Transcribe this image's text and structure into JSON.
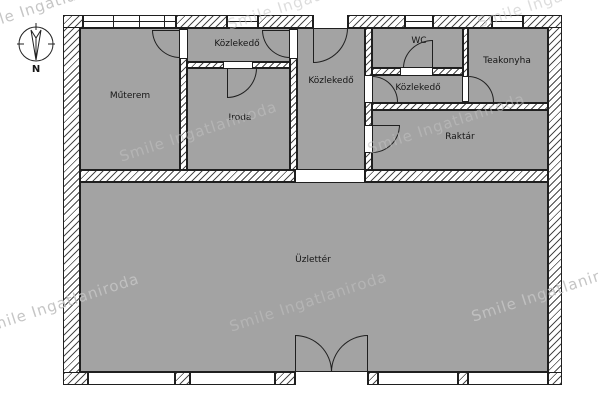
{
  "plan": {
    "compass_label": "N",
    "watermark_text": "Smile Ingatlaniroda",
    "rooms": [
      {
        "name": "muterem",
        "label": "Műterem"
      },
      {
        "name": "kozlekedo_top_left",
        "label": "Közlekedő"
      },
      {
        "name": "iroda",
        "label": "Iroda"
      },
      {
        "name": "kozlekedo_middle",
        "label": "Közlekedő"
      },
      {
        "name": "wc",
        "label": "WC"
      },
      {
        "name": "kozlekedo_right",
        "label": "Közlekedő"
      },
      {
        "name": "teakonyha",
        "label": "Teakonyha"
      },
      {
        "name": "raktar",
        "label": "Raktár"
      },
      {
        "name": "uzletter",
        "label": "Üzlettér"
      }
    ],
    "colors": {
      "room_fill": "#a3a3a3",
      "wall_line": "#1f1f1f",
      "hatch_line": "#4a4a4a",
      "watermark": "#c2c2c2"
    }
  }
}
